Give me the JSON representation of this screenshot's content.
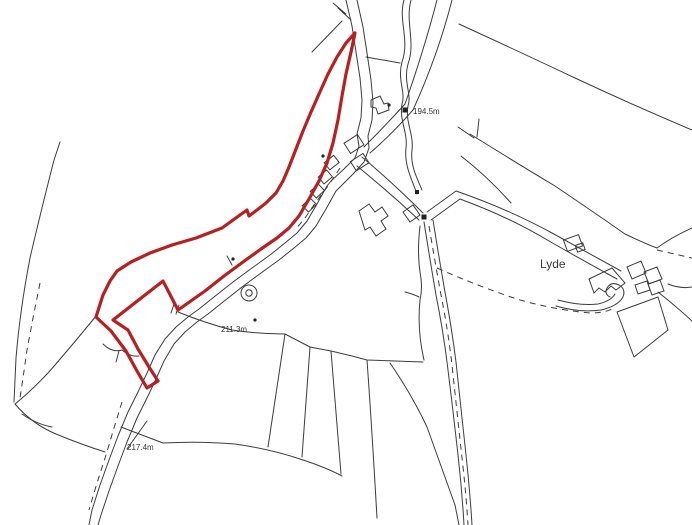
{
  "map": {
    "background_color": "#ffffff",
    "linework_color": "#3c3c3c",
    "boundary": {
      "color": "#b62021",
      "path": "M355,33 L351,52 346,74 342,96 338,120 333,143 327,163 319,181 309,199 299,216 289,228 277,238 261,249 243,262 224,276 205,291 188,303 178,310 163,281 113,320 128,330 138,349 149,367 158,381 147,388 137,371 126,351 111,331 96,317 103,295 110,281 117,271 131,262 150,253 172,245 196,238 222,228 240,215 247,210 249,216 257,210 266,203 276,193 283,181 289,167 296,149 303,131 311,112 319,94 328,74 337,57 346,43 Z"
    },
    "labels": {
      "spot_heights": [
        {
          "text": "194.5m",
          "x": 413,
          "y": 114
        },
        {
          "text": "211.3m",
          "x": 221,
          "y": 332
        },
        {
          "text": "217.4m",
          "x": 127,
          "y": 450
        }
      ],
      "place": {
        "text": "Lyde",
        "x": 540,
        "y": 268
      }
    },
    "markers": [
      {
        "type": "square",
        "x": 405,
        "y": 110,
        "size": 5
      },
      {
        "type": "square",
        "x": 424,
        "y": 217,
        "size": 5
      },
      {
        "type": "square",
        "x": 417,
        "y": 192,
        "size": 4
      },
      {
        "type": "dot",
        "x": 389,
        "y": 105,
        "r": 1.6
      },
      {
        "type": "dot",
        "x": 323,
        "y": 156,
        "r": 1.6
      },
      {
        "type": "dot",
        "x": 255,
        "y": 320,
        "r": 1.6
      },
      {
        "type": "dot",
        "x": 233,
        "y": 259,
        "r": 1.6
      }
    ]
  }
}
